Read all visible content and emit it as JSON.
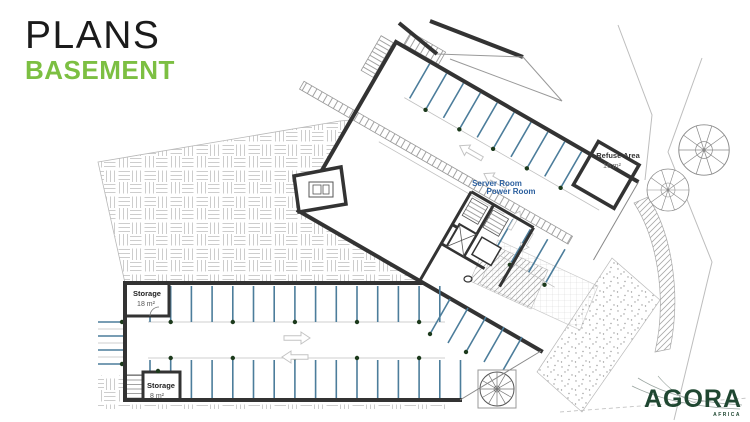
{
  "header": {
    "title": "PLANS",
    "subtitle": "BASEMENT"
  },
  "plan_labels": {
    "server_room": "Server Room",
    "power_room": "Power Room",
    "refuse_name": "Refuse Area",
    "refuse_area": "16 m²",
    "storage1_name": "Storage",
    "storage1_area": "18 m²",
    "storage2_name": "Storage",
    "storage2_area": "8 m²"
  },
  "logo": {
    "name": "AGORA",
    "region": "AFRICA"
  },
  "colors": {
    "accent_green": "#7cbf42",
    "wall": "#333333",
    "parking_blue": "#4c7d9b",
    "dot_green": "#1c3a1c",
    "label_blue": "#2b5f9e",
    "logo_green": "#1f4731"
  }
}
